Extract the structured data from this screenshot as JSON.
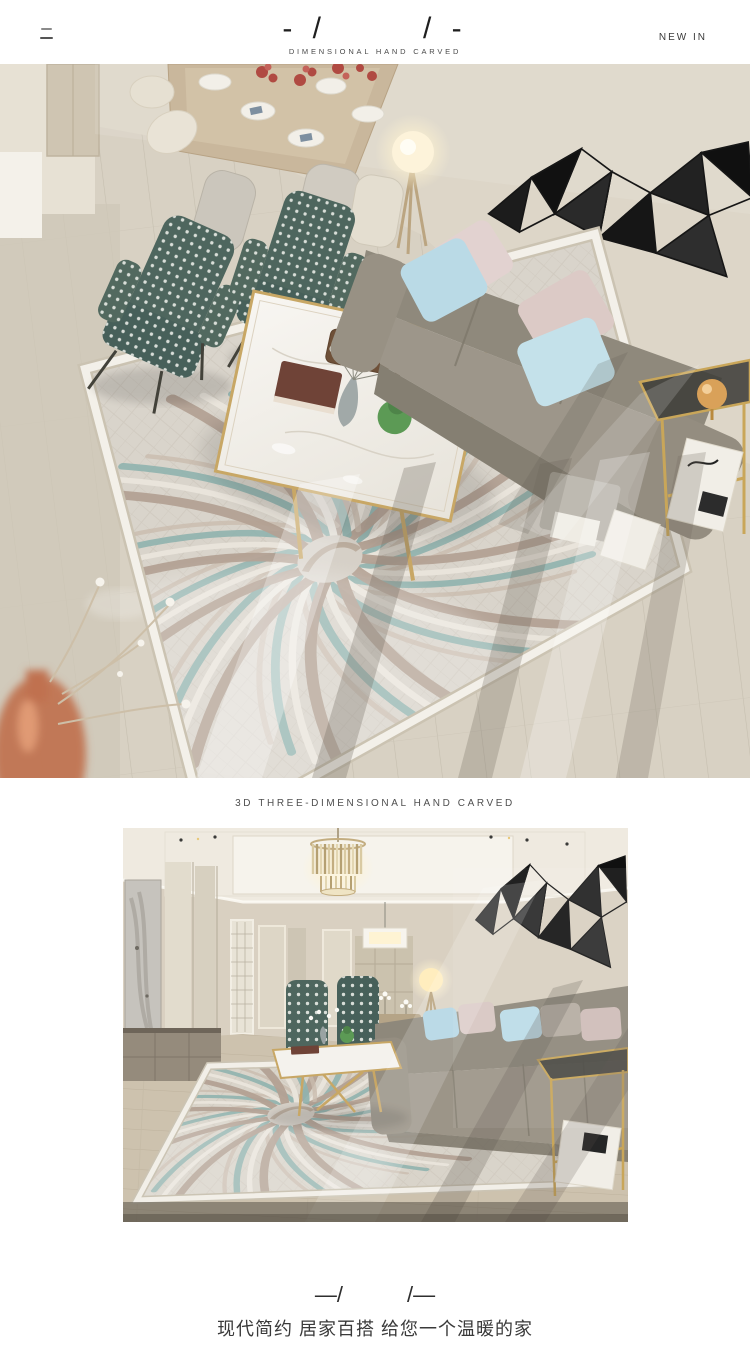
{
  "header": {
    "mark_left": "- /",
    "mark_right": "/ -",
    "caption": "DIMENSIONAL HAND CARVED",
    "new_in": "NEW IN"
  },
  "section": {
    "caption": "3D THREE-DIMENSIONAL HAND CARVED"
  },
  "footer": {
    "mark_left": "—/",
    "mark_right": "/—",
    "tagline": "现代简约 居家百搭  给您一个温暖的家"
  },
  "images": {
    "top_view_label": "living-room-top-view-with-flower-swirl-carpet",
    "room_view_label": "living-room-front-view-with-flower-swirl-carpet"
  },
  "colors": {
    "background": "#ffffff",
    "text": "#3a3a3a",
    "wall": "#dcd4c6",
    "floor_wood": "#d7d0c2",
    "carpet_base": "#d9d4cb",
    "carpet_teal": "#8fb3ae",
    "carpet_taupe": "#b3a193",
    "sofa_gray": "#9c9588",
    "armchair_teal": "#4e665e",
    "pillow_blue": "#bcdce8",
    "pillow_pink": "#e2d2d0",
    "gold_accent": "#c8a765",
    "art_black": "#1a1a1a"
  }
}
